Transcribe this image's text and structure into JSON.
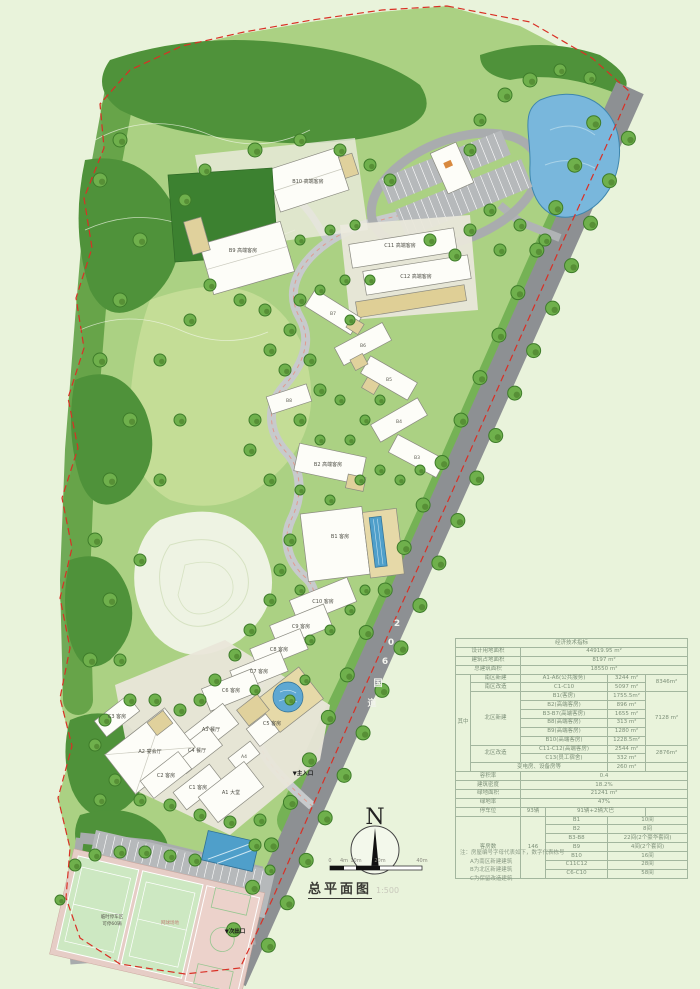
{
  "drawing": {
    "title": "总平面图",
    "scale": "1:500",
    "north_label": "N",
    "scale_bar": [
      "0",
      "4m",
      "10m",
      "20m",
      "40m"
    ],
    "road_name_chars": [
      "2",
      "0",
      "6",
      "国",
      "道"
    ],
    "entrance_main": "▼主入口",
    "exit_secondary": "▼次出口"
  },
  "buildings": {
    "b10": "B10 高端客房",
    "b9": "B9 高端客房",
    "c11": "C11 高端客房",
    "c12": "C12 高端客房",
    "b8": "B8",
    "b7": "B7",
    "b6": "B6",
    "b5": "B5",
    "b4": "B4",
    "b3": "B3",
    "b2": "B2 高端客房",
    "b1": "B1 客房",
    "c10": "C10 客房",
    "c9": "C9 客房",
    "c8": "C8 客房",
    "c7": "C7 客房",
    "c6": "C6 客房",
    "c5": "C5 客房",
    "a3": "A3 餐厅",
    "c4": "C4 餐厅",
    "a2": "A2 宴会厅",
    "a4": "A4",
    "c3": "C3 客房",
    "c2": "C2 客房",
    "c1": "C1 客房",
    "a1": "A1 大堂",
    "temp_parking_l1": "临时停车区",
    "temp_parking_l2": "可停60辆",
    "court": "网球场地"
  },
  "table": {
    "title": "经济技术指标",
    "top_rows": [
      {
        "label": "设计用地面积",
        "value": "44919.95 m²"
      },
      {
        "label": "建筑占地面积",
        "value": "8197  m²"
      },
      {
        "label": "总建筑面积",
        "value": "18550  m²"
      }
    ],
    "among_label": "其中",
    "among": [
      {
        "cat": "南区新建",
        "name": "A1-A6(公共服务)",
        "area": "3244 m²",
        "sub": "8346m²"
      },
      {
        "cat": "南区改造",
        "name": "C1-C10",
        "area": "5097 m²"
      },
      {
        "cat": "北区新建",
        "name": "B1(客房)",
        "area": "1755.5m²",
        "sub": "7128 m²"
      },
      {
        "name": "B2(高端客房)",
        "area": "896  m²"
      },
      {
        "name": "B3-B7(高端客房)",
        "area": "1655  m²"
      },
      {
        "name": "B8(高端客房)",
        "area": "313  m²"
      },
      {
        "name": "B9(高端客房)",
        "area": "1280  m²"
      },
      {
        "name": "B10(高端客房)",
        "area": "1228.5m²"
      },
      {
        "cat": "北区改造",
        "name": "C11-C12(高端客房)",
        "area": "2544 m²",
        "sub": "2876m²"
      },
      {
        "name": "C13(员工宿舍)",
        "area": "332  m²"
      },
      {
        "cat": "变电房、设备房等",
        "area": "260  m²"
      }
    ],
    "bottom_rows": [
      {
        "label": "容积率",
        "value": "0.4"
      },
      {
        "label": "建筑密度",
        "value": "18.2%"
      },
      {
        "label": "绿地面积",
        "value": "21241  m²"
      },
      {
        "label": "绿地率",
        "value": "47%"
      }
    ],
    "parking": {
      "label": "停车位",
      "total": "93辆",
      "detail": "91辆+2辆大巴"
    },
    "rooms": {
      "label": "客房数",
      "total": "146",
      "items": [
        {
          "name": "B1",
          "count": "10间"
        },
        {
          "name": "B2",
          "count": "8间"
        },
        {
          "name": "B3-B8",
          "count": "22间(2个豪华套间)"
        },
        {
          "name": "B9",
          "count": "4间(2个套间)"
        },
        {
          "name": "B10",
          "count": "16间"
        },
        {
          "name": "C11C12",
          "count": "28间"
        },
        {
          "name": "C6-C10",
          "count": "58间"
        }
      ]
    }
  },
  "notes": [
    "注：房屋编号字母代表如下，数字代表栋号",
    "A为南区新建建筑",
    "B为北区新建建筑",
    "C为保留改造建筑"
  ],
  "colors": {
    "boundary_red": "#d93025",
    "water_blue": "#6fb0d6",
    "road_gray": "#8d9093",
    "forest_green": "#4f923a",
    "accent_pink": "#e09a8e"
  }
}
